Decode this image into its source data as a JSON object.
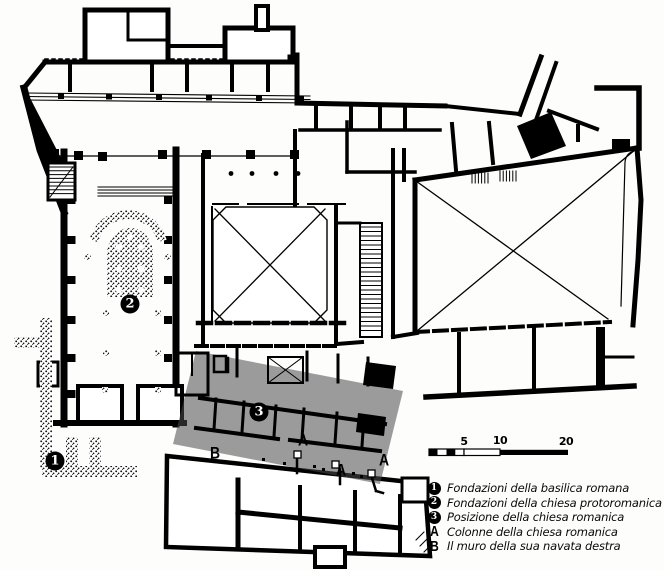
{
  "plan": {
    "badges": [
      {
        "id": "1",
        "meaning": "Fondazioni della basilica romana"
      },
      {
        "id": "2",
        "meaning": "Fondazioni della chiesa protoromanica"
      },
      {
        "id": "3",
        "meaning": "Posizione della chiesa romanica"
      }
    ],
    "letters": [
      {
        "id": "B"
      },
      {
        "id": "A"
      },
      {
        "id": "A"
      },
      {
        "id": "A"
      }
    ]
  },
  "scale_bar": {
    "labels": [
      {
        "text": "5"
      },
      {
        "text": "10"
      },
      {
        "text": "20"
      }
    ]
  },
  "legend": {
    "items": [
      {
        "key": "1",
        "icon": "circled-number-badge",
        "text": "Fondazioni della basilica romana"
      },
      {
        "key": "2",
        "icon": "circled-number-badge",
        "text": "Fondazioni della chiesa protoromanica"
      },
      {
        "key": "3",
        "icon": "circled-number-badge",
        "text": "Posizione della chiesa romanica"
      },
      {
        "key": "A",
        "icon": "bold-letter",
        "text": "Colonne della chiesa romanica"
      },
      {
        "key": "B",
        "icon": "bold-letter",
        "text": "Il muro della sua navata destra"
      }
    ]
  },
  "colors": {
    "wall": "#000000",
    "overlay_gray": "#9b9b9b",
    "background": "#ffffff"
  }
}
